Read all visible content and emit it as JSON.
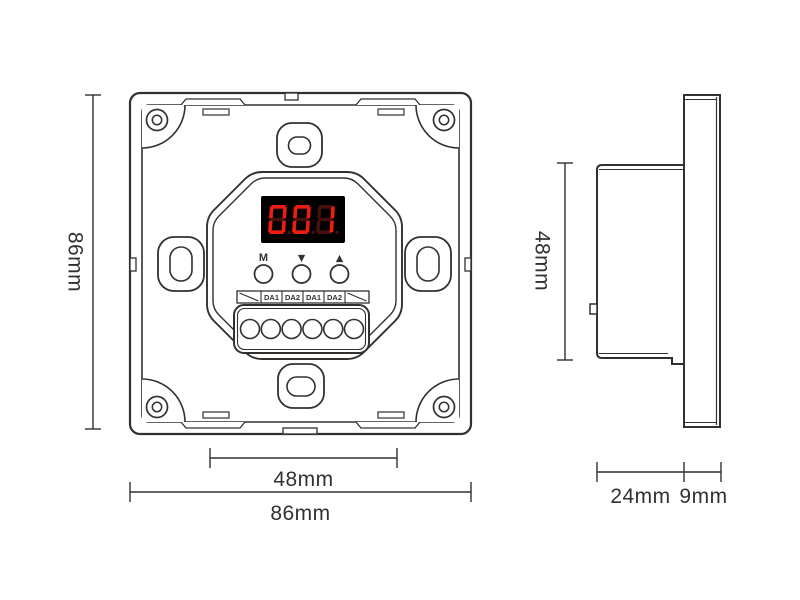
{
  "drawing": {
    "kind": "wall-panel dimension drawing",
    "views": {
      "front": "front view",
      "side": "side view"
    }
  },
  "colors": {
    "line": "#33302e",
    "background": "#ffffff"
  },
  "front_view": {
    "display": {
      "value": "001",
      "color_lit": "#ee1c12",
      "color_ghost": "#45110d",
      "background": "#000000"
    },
    "buttons": [
      "M",
      "▼",
      "▲"
    ],
    "terminal_labels": [
      "DA1",
      "DA2",
      "DA1",
      "DA2"
    ],
    "terminal_hole_count": 6
  },
  "dimensions": {
    "front_height": "86mm",
    "front_width": "86mm",
    "module_width": "48mm",
    "side_height": "48mm",
    "depth_back": "24mm",
    "depth_front": "9mm"
  }
}
